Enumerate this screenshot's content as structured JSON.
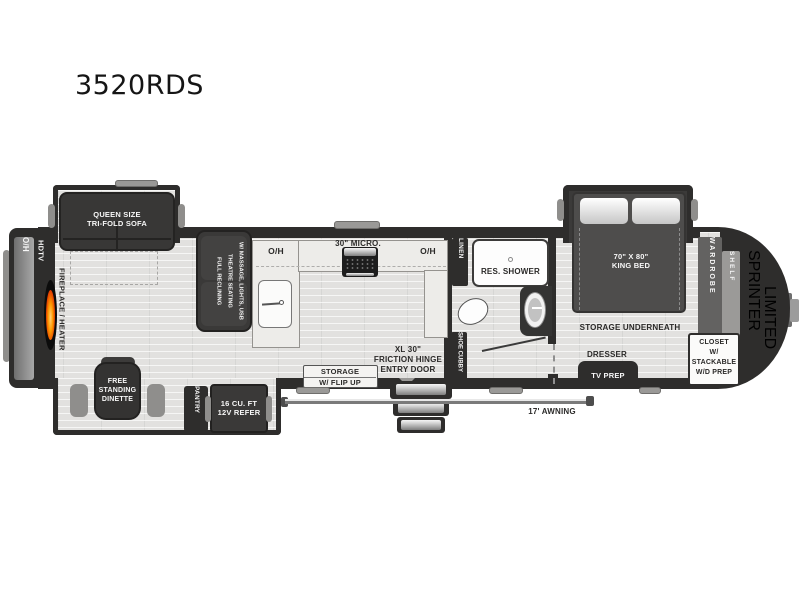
{
  "title": "3520RDS",
  "colors": {
    "wall": "#2e2d2c",
    "floor": "#e2e1df",
    "flame": "#ff7a00",
    "counter": "#edece9"
  },
  "labels": {
    "rear_overhead": "O/H",
    "hdtv": "HDTV",
    "fireplace": "FIREPLACE / HEATER",
    "sofa": "QUEEN SIZE\nTRI-FOLD SOFA",
    "theatre": "FULL RECLINING\nTHEATRE SEATING\nW/ MASSAGE, LIGHTS, USB",
    "kitchen_oh_left": "O/H",
    "kitchen_oh_right": "O/H",
    "micro": "30\" MICRO.",
    "storage_flip_title": "STORAGE",
    "storage_flip_sub": "W/ FLIP UP",
    "entry_door": "XL 30\"\nFRICTION HINGE\nENTRY DOOR",
    "linen": "LINEN",
    "shower": "RES. SHOWER",
    "shoe_cubby": "SHOE CUBBY",
    "king_bed": "70\" X 80\"\nKING BED",
    "storage_underneath": "STORAGE UNDERNEATH",
    "dresser": "DRESSER",
    "tv_prep": "TV PREP",
    "wardrobe": "WARDROBE",
    "shelf": "SHELF",
    "closet": "CLOSET\nW/\nSTACKABLE\nW/D PREP",
    "brand": "SPRINTER",
    "brand_sub": "LIMITED",
    "awning": "17' AWNING",
    "dinette": "FREE\nSTANDING\nDINETTE",
    "pantry": "PANTRY",
    "refer": "16 CU. FT\n12V REFER"
  }
}
